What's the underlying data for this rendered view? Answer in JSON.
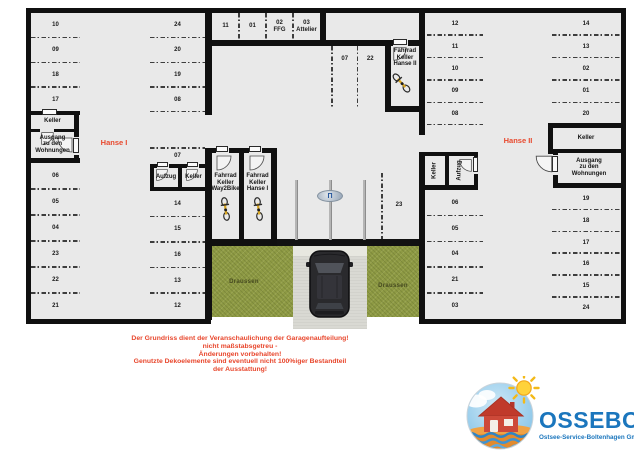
{
  "h1": {
    "label": "Hanse I",
    "left_top": [
      "10",
      "09",
      "18",
      "17"
    ],
    "left_bottom": [
      "06",
      "05",
      "04",
      "23",
      "22",
      "21"
    ],
    "mid_top": [
      "24",
      "20",
      "19",
      "08"
    ],
    "mid_bottom": [
      "14",
      "15",
      "16",
      "13",
      "12"
    ],
    "space07": "07",
    "keller": "Keller",
    "ausgang": "Ausgang\nzu den\nWohnungen",
    "aufzug": "Aufzug",
    "keller_mid": "Keller",
    "bike1": "Fahrrad\nKeller\nWay2Bike",
    "bike2": "Fahrrad\nKeller\nHanse I"
  },
  "top_row": [
    "11",
    "01",
    "02\nFFG",
    "03\nAttelier"
  ],
  "h2": {
    "label": "Hanse II",
    "pair": [
      "07",
      "22"
    ],
    "space23": "23",
    "bike": "Fahrrad\nKeller\nHanse II",
    "left_top": [
      "12",
      "11",
      "10",
      "09",
      "08"
    ],
    "left_bottom": [
      "06",
      "05",
      "04",
      "21",
      "03"
    ],
    "right_top": [
      "14",
      "13",
      "02",
      "01",
      "20"
    ],
    "right_bottom": [
      "19",
      "18",
      "17",
      "16",
      "15",
      "24"
    ],
    "keller_rot": "Keller",
    "aufzug_rot": "Aufzug",
    "keller_right": "Keller",
    "ausgang": "Ausgang\nzu den\nWohnungen"
  },
  "outside": {
    "left": "Draussen",
    "mid": "Draussen",
    "right": "Draussen"
  },
  "sign_glyph": "Π",
  "disclaimer": [
    "Der Grundriss dient der Veranschaulichung der Garagenaufteilung!",
    "nicht maßstabsgetreu -",
    "Änderungen vorbehalten!",
    "Genutzte Dekoelemente sind eventuell nicht 100%iger Bestandteil",
    "der Ausstattung!"
  ],
  "logo": {
    "name": "OSSEBO",
    "subtitle": "Ostsee-Service-Boltenhagen GmbH"
  },
  "colors": {
    "accent_red": "#e8462c",
    "logo_blue": "#1b76bd",
    "wall": "#101010",
    "floor": "#e9e9e9",
    "grass": "#8e9a44"
  }
}
